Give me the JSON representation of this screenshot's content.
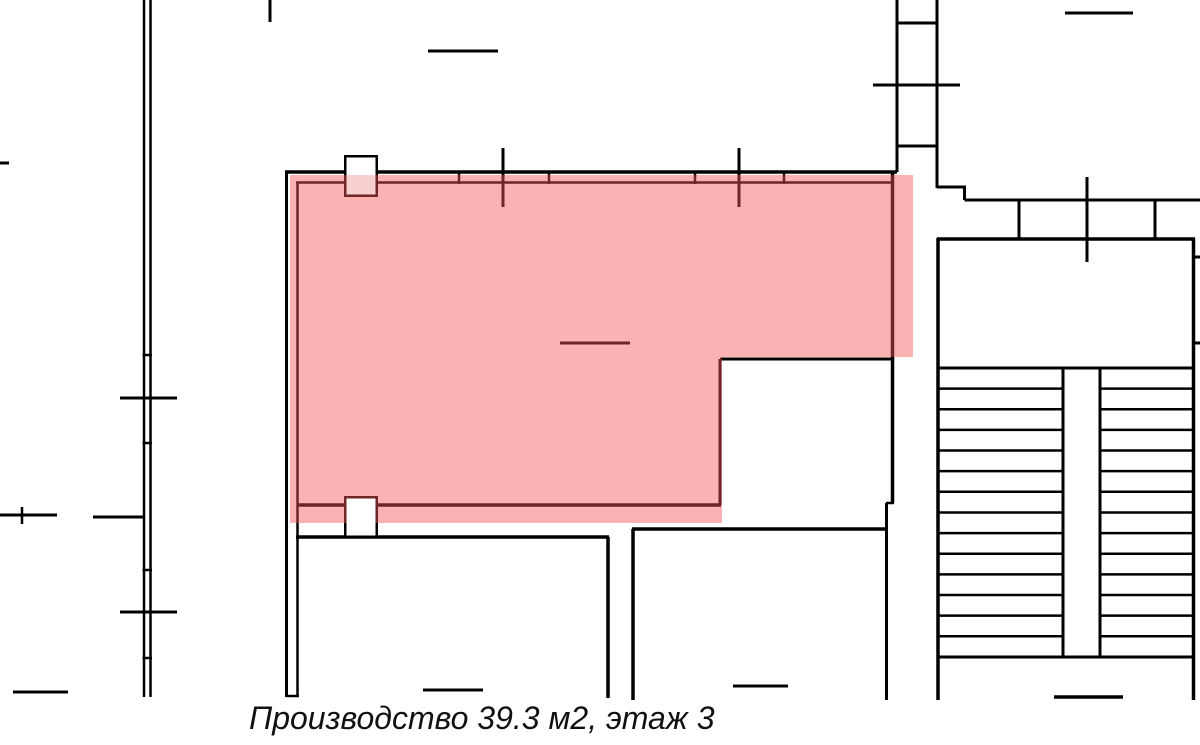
{
  "caption": {
    "text": "Производство 39.3 м2, этаж 3"
  },
  "room": {
    "name": "Производство",
    "area_m2": "39.3",
    "floor": "3"
  },
  "colors": {
    "background": "#ffffff",
    "wall": "#000000",
    "highlight": "rgba(244,84,86,0.45)",
    "caption": "#111111"
  },
  "floor_plan": {
    "width": 1200,
    "height": 745,
    "lines": [
      [
        144,
        0,
        144,
        697,
        2.5
      ],
      [
        150.5,
        0,
        150.5,
        697,
        2.5
      ],
      [
        142.5,
        355,
        152,
        355,
        2.5
      ],
      [
        142.5,
        443,
        152,
        443,
        2.5
      ],
      [
        142.5,
        570,
        152,
        570,
        2.5
      ],
      [
        142.5,
        658,
        152,
        658,
        2.5
      ],
      [
        120,
        398,
        177,
        398,
        3
      ],
      [
        120,
        612,
        177,
        612,
        3
      ],
      [
        0,
        163,
        9,
        163,
        3
      ],
      [
        0,
        515,
        57,
        515,
        3
      ],
      [
        22,
        507,
        22,
        524,
        2.5
      ],
      [
        93,
        517,
        145,
        517,
        3
      ],
      [
        13,
        692,
        68,
        692,
        3
      ],
      [
        270,
        0,
        270,
        22,
        3
      ],
      [
        428,
        51,
        498,
        51,
        3
      ],
      [
        285,
        172,
        897,
        172,
        3.5
      ],
      [
        296,
        182.5,
        893,
        182.5,
        2.5
      ],
      [
        286.5,
        172,
        286.5,
        697,
        3
      ],
      [
        297.5,
        182,
        297.5,
        697,
        2.5
      ],
      [
        286,
        696,
        299,
        696,
        2.5
      ],
      [
        297,
        505,
        721,
        505,
        3.5
      ],
      [
        720,
        359,
        720,
        505,
        3
      ],
      [
        720,
        359,
        894,
        359,
        3
      ],
      [
        892.5,
        172,
        892.5,
        503,
        3.5
      ],
      [
        886,
        503,
        894,
        503,
        2.5
      ],
      [
        886.5,
        503,
        886.5,
        700,
        3
      ],
      [
        459,
        171,
        459,
        184,
        2.5
      ],
      [
        549,
        171,
        549,
        184,
        2.5
      ],
      [
        695,
        171,
        695,
        184,
        2.5
      ],
      [
        784,
        171,
        784,
        184,
        2.5
      ],
      [
        503,
        148,
        503,
        207,
        3
      ],
      [
        739,
        148,
        739,
        207,
        3
      ],
      [
        560,
        343,
        630,
        343,
        3
      ],
      [
        897,
        0,
        897,
        172,
        3
      ],
      [
        937,
        0,
        937,
        188,
        3
      ],
      [
        897,
        23,
        937,
        23,
        3
      ],
      [
        873,
        85,
        960,
        85,
        3
      ],
      [
        897,
        146,
        937,
        146,
        3
      ],
      [
        937,
        187,
        966,
        187,
        3
      ],
      [
        964.5,
        187,
        964.5,
        200,
        3
      ],
      [
        964.5,
        200,
        1200,
        200,
        3
      ],
      [
        1019,
        200,
        1019,
        238,
        3
      ],
      [
        1087,
        177,
        1087,
        262,
        3
      ],
      [
        1155,
        200,
        1155,
        238,
        3
      ],
      [
        1065,
        13,
        1133,
        13,
        3
      ],
      [
        938,
        238,
        938,
        700,
        3.5
      ],
      [
        1193.5,
        238,
        1193.5,
        700,
        3.5
      ],
      [
        937,
        239,
        1195,
        239,
        3.5
      ],
      [
        937,
        368,
        1195,
        368,
        3
      ],
      [
        937,
        657,
        1195,
        657,
        3
      ],
      [
        1063,
        368,
        1063,
        657,
        3
      ],
      [
        1100,
        368,
        1100,
        657,
        3
      ],
      [
        1054,
        697,
        1123,
        697,
        3.5
      ],
      [
        1194,
        257,
        1200,
        257,
        3
      ],
      [
        1194,
        343,
        1200,
        343,
        3
      ],
      [
        296,
        537,
        609,
        537,
        3.5
      ],
      [
        608,
        537,
        608,
        698,
        3.5
      ],
      [
        423,
        690,
        483,
        690,
        3
      ],
      [
        632,
        529,
        887,
        529,
        3.5
      ],
      [
        633,
        529,
        633,
        700,
        3.5
      ],
      [
        733,
        686,
        788,
        686,
        3
      ]
    ],
    "door_squares": [
      [
        344,
        155,
        34,
        42
      ],
      [
        344,
        496,
        34,
        42
      ]
    ],
    "door_stroke_width": 3,
    "stair_treads": {
      "y_first": 388.6,
      "step": 20.64,
      "count": 13,
      "left_span": [
        938,
        1063
      ],
      "right_span": [
        1100,
        1193
      ],
      "width": 2.5
    },
    "highlight_rects": [
      [
        290,
        175,
        623,
        182
      ],
      [
        290,
        357,
        432,
        166
      ]
    ],
    "post_fills": [
      {
        "rect": [
          346.5,
          157.5,
          29,
          17.5
        ],
        "fill": "#ffffff"
      },
      {
        "rect": [
          346.5,
          175,
          29,
          19.5
        ],
        "fill": "#f9d0d0"
      },
      {
        "rect": [
          346.5,
          498.5,
          29,
          37
        ],
        "fill": "#ffffff"
      }
    ]
  }
}
